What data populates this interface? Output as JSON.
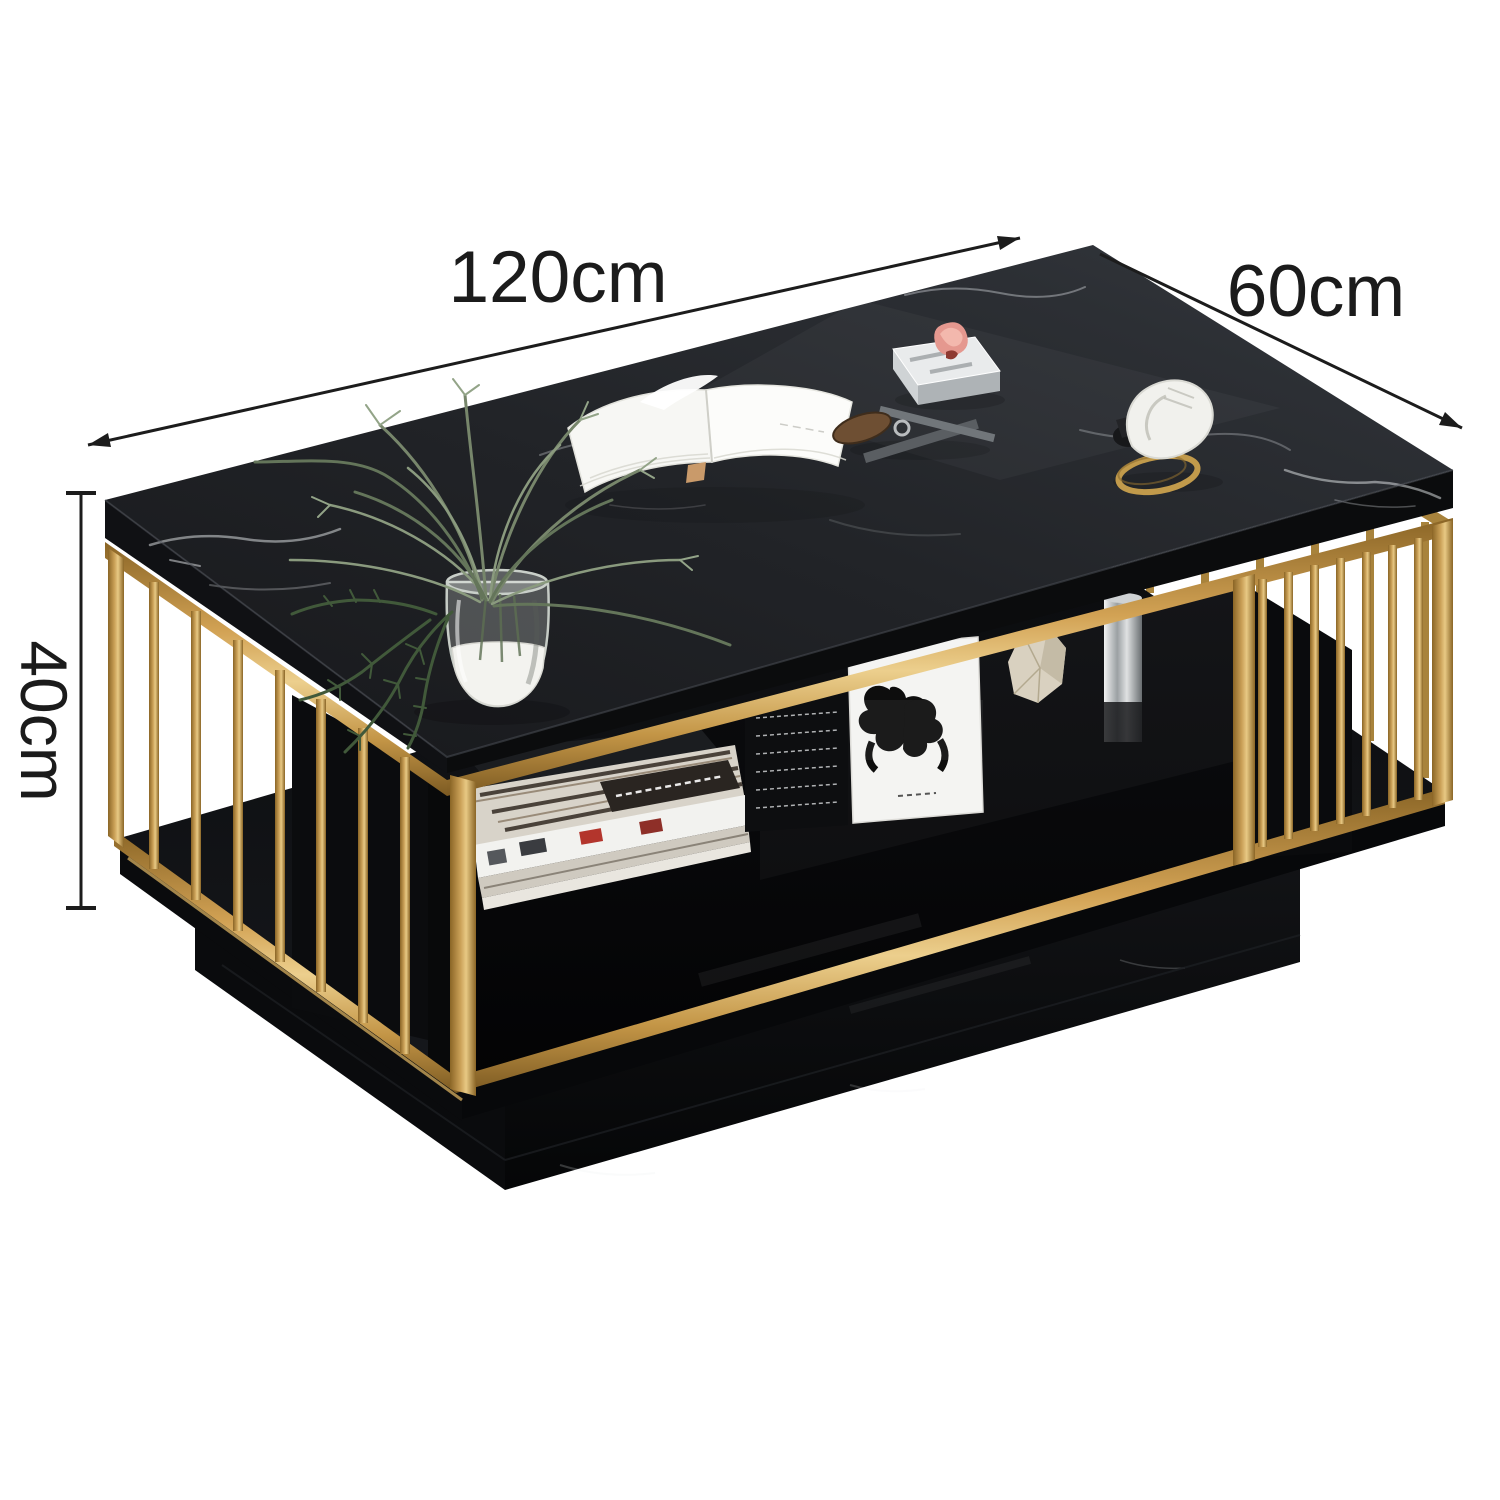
{
  "image": {
    "background": "#ffffff",
    "alt": "Black marble coffee table with gold stainless-steel cage frame, open storage shelf and plinth base, annotated with product dimensions"
  },
  "dimensions": {
    "length": {
      "label": "120cm"
    },
    "depth": {
      "label": "60cm"
    },
    "height": {
      "label": "40cm"
    }
  },
  "style": {
    "dimension_text_color": "#1b1b1b",
    "dimension_line_color": "#1c1c1c",
    "gold_accent": "#c9a04e",
    "marble_black": "#1a1c20",
    "vein_white": "#e7ebee",
    "background": "#ffffff"
  },
  "scene": {
    "furniture": "coffee-table",
    "decor_items": [
      "fern-plant",
      "glass-vase",
      "open-book",
      "silver-tray",
      "pink-flower-box",
      "key-set",
      "white-slipper",
      "gold-bangle",
      "magazine-stack",
      "black-book-box",
      "abstract-art-card",
      "stone-decor",
      "chrome-vessel"
    ]
  }
}
